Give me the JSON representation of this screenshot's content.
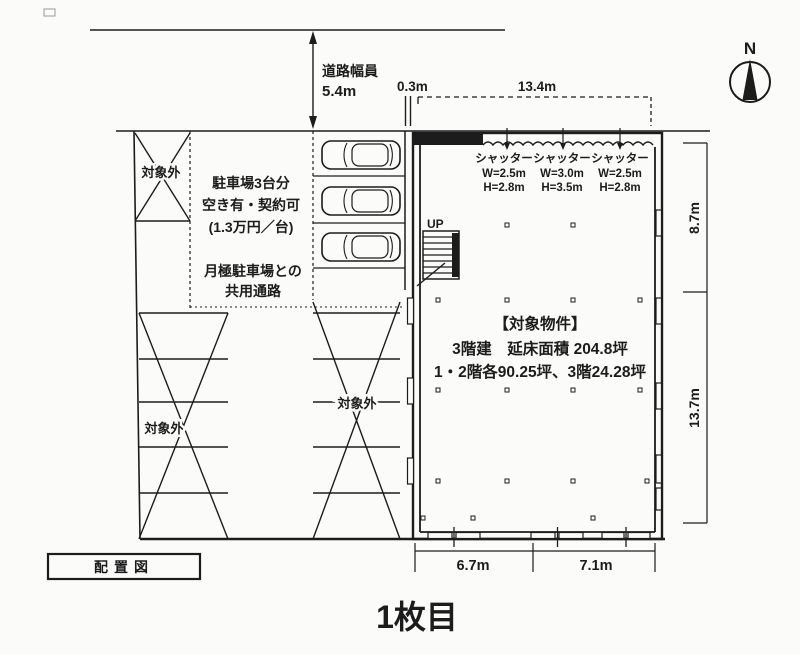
{
  "page": {
    "title": "1枚目"
  },
  "drawing": {
    "label": "配置図"
  },
  "colors": {
    "ink": "#1c1c1c",
    "paper": "#fbfbf9"
  },
  "compass": {
    "north": "N"
  },
  "road": {
    "name": "道路幅員",
    "width": "5.4m"
  },
  "dims": {
    "gap": "0.3m",
    "building_width": "13.4m",
    "right_top": "8.7m",
    "right_bottom": "13.7m",
    "bottom_left": "6.7m",
    "bottom_right": "7.1m"
  },
  "parking": {
    "info_line1": "駐車場3台分",
    "info_line2": "空き有・契約可",
    "info_line3": "(1.3万円／台)",
    "shared_line1": "月極駐車場との",
    "shared_line2": "共用通路",
    "excluded": "対象外"
  },
  "building": {
    "up": "UP",
    "title": "【対象物件】",
    "desc_line1": "3階建　延床面積 204.8坪",
    "desc_line2": "1・2階各90.25坪、3階24.28坪",
    "shutters": [
      {
        "label": "シャッター",
        "w": "W=2.5m",
        "h": "H=2.8m"
      },
      {
        "label": "シャッター",
        "w": "W=3.0m",
        "h": "H=3.5m"
      },
      {
        "label": "シャッター",
        "w": "W=2.5m",
        "h": "H=2.8m"
      }
    ]
  }
}
